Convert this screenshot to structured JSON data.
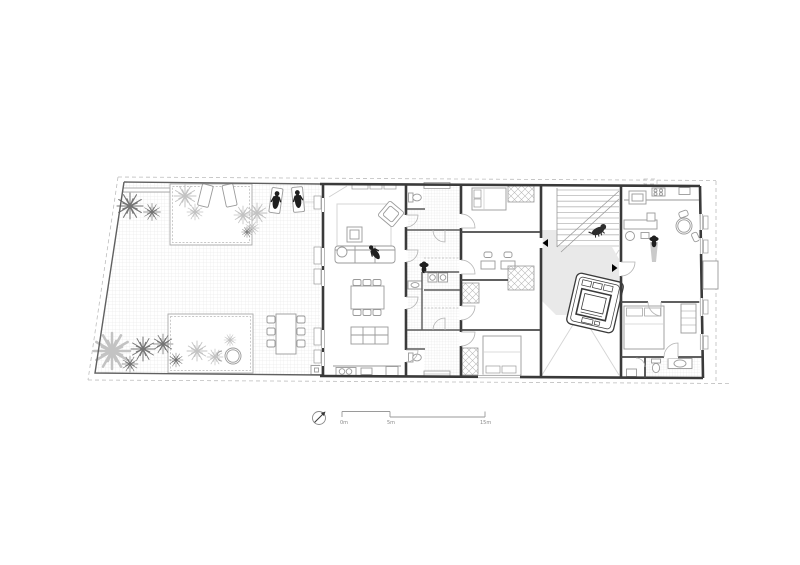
{
  "drawing": {
    "type": "floor-plan",
    "description": "single-storey plan with walled courtyard terrace, living unit, service corridor, bedroom wing, stair hall with car, and end apartment"
  },
  "scale_bar": {
    "labels": [
      "0m",
      "5m",
      "15m"
    ]
  },
  "north_arrow": {
    "symbol": "compass-arrow-northeast"
  },
  "colors": {
    "background": "#ffffff",
    "walls": "#3a3a3a",
    "furniture_line": "#9a9a9a",
    "grid_line": "#e3e3e3",
    "hatch_line": "#e0e0e0",
    "shaded_floor": "#e9e9e9",
    "figures": "#1f1f1f",
    "plants_dark": "#757575",
    "plants_light": "#c3c3c3",
    "dashed_boundary": "#bdbdbd",
    "marker": "#000000"
  }
}
